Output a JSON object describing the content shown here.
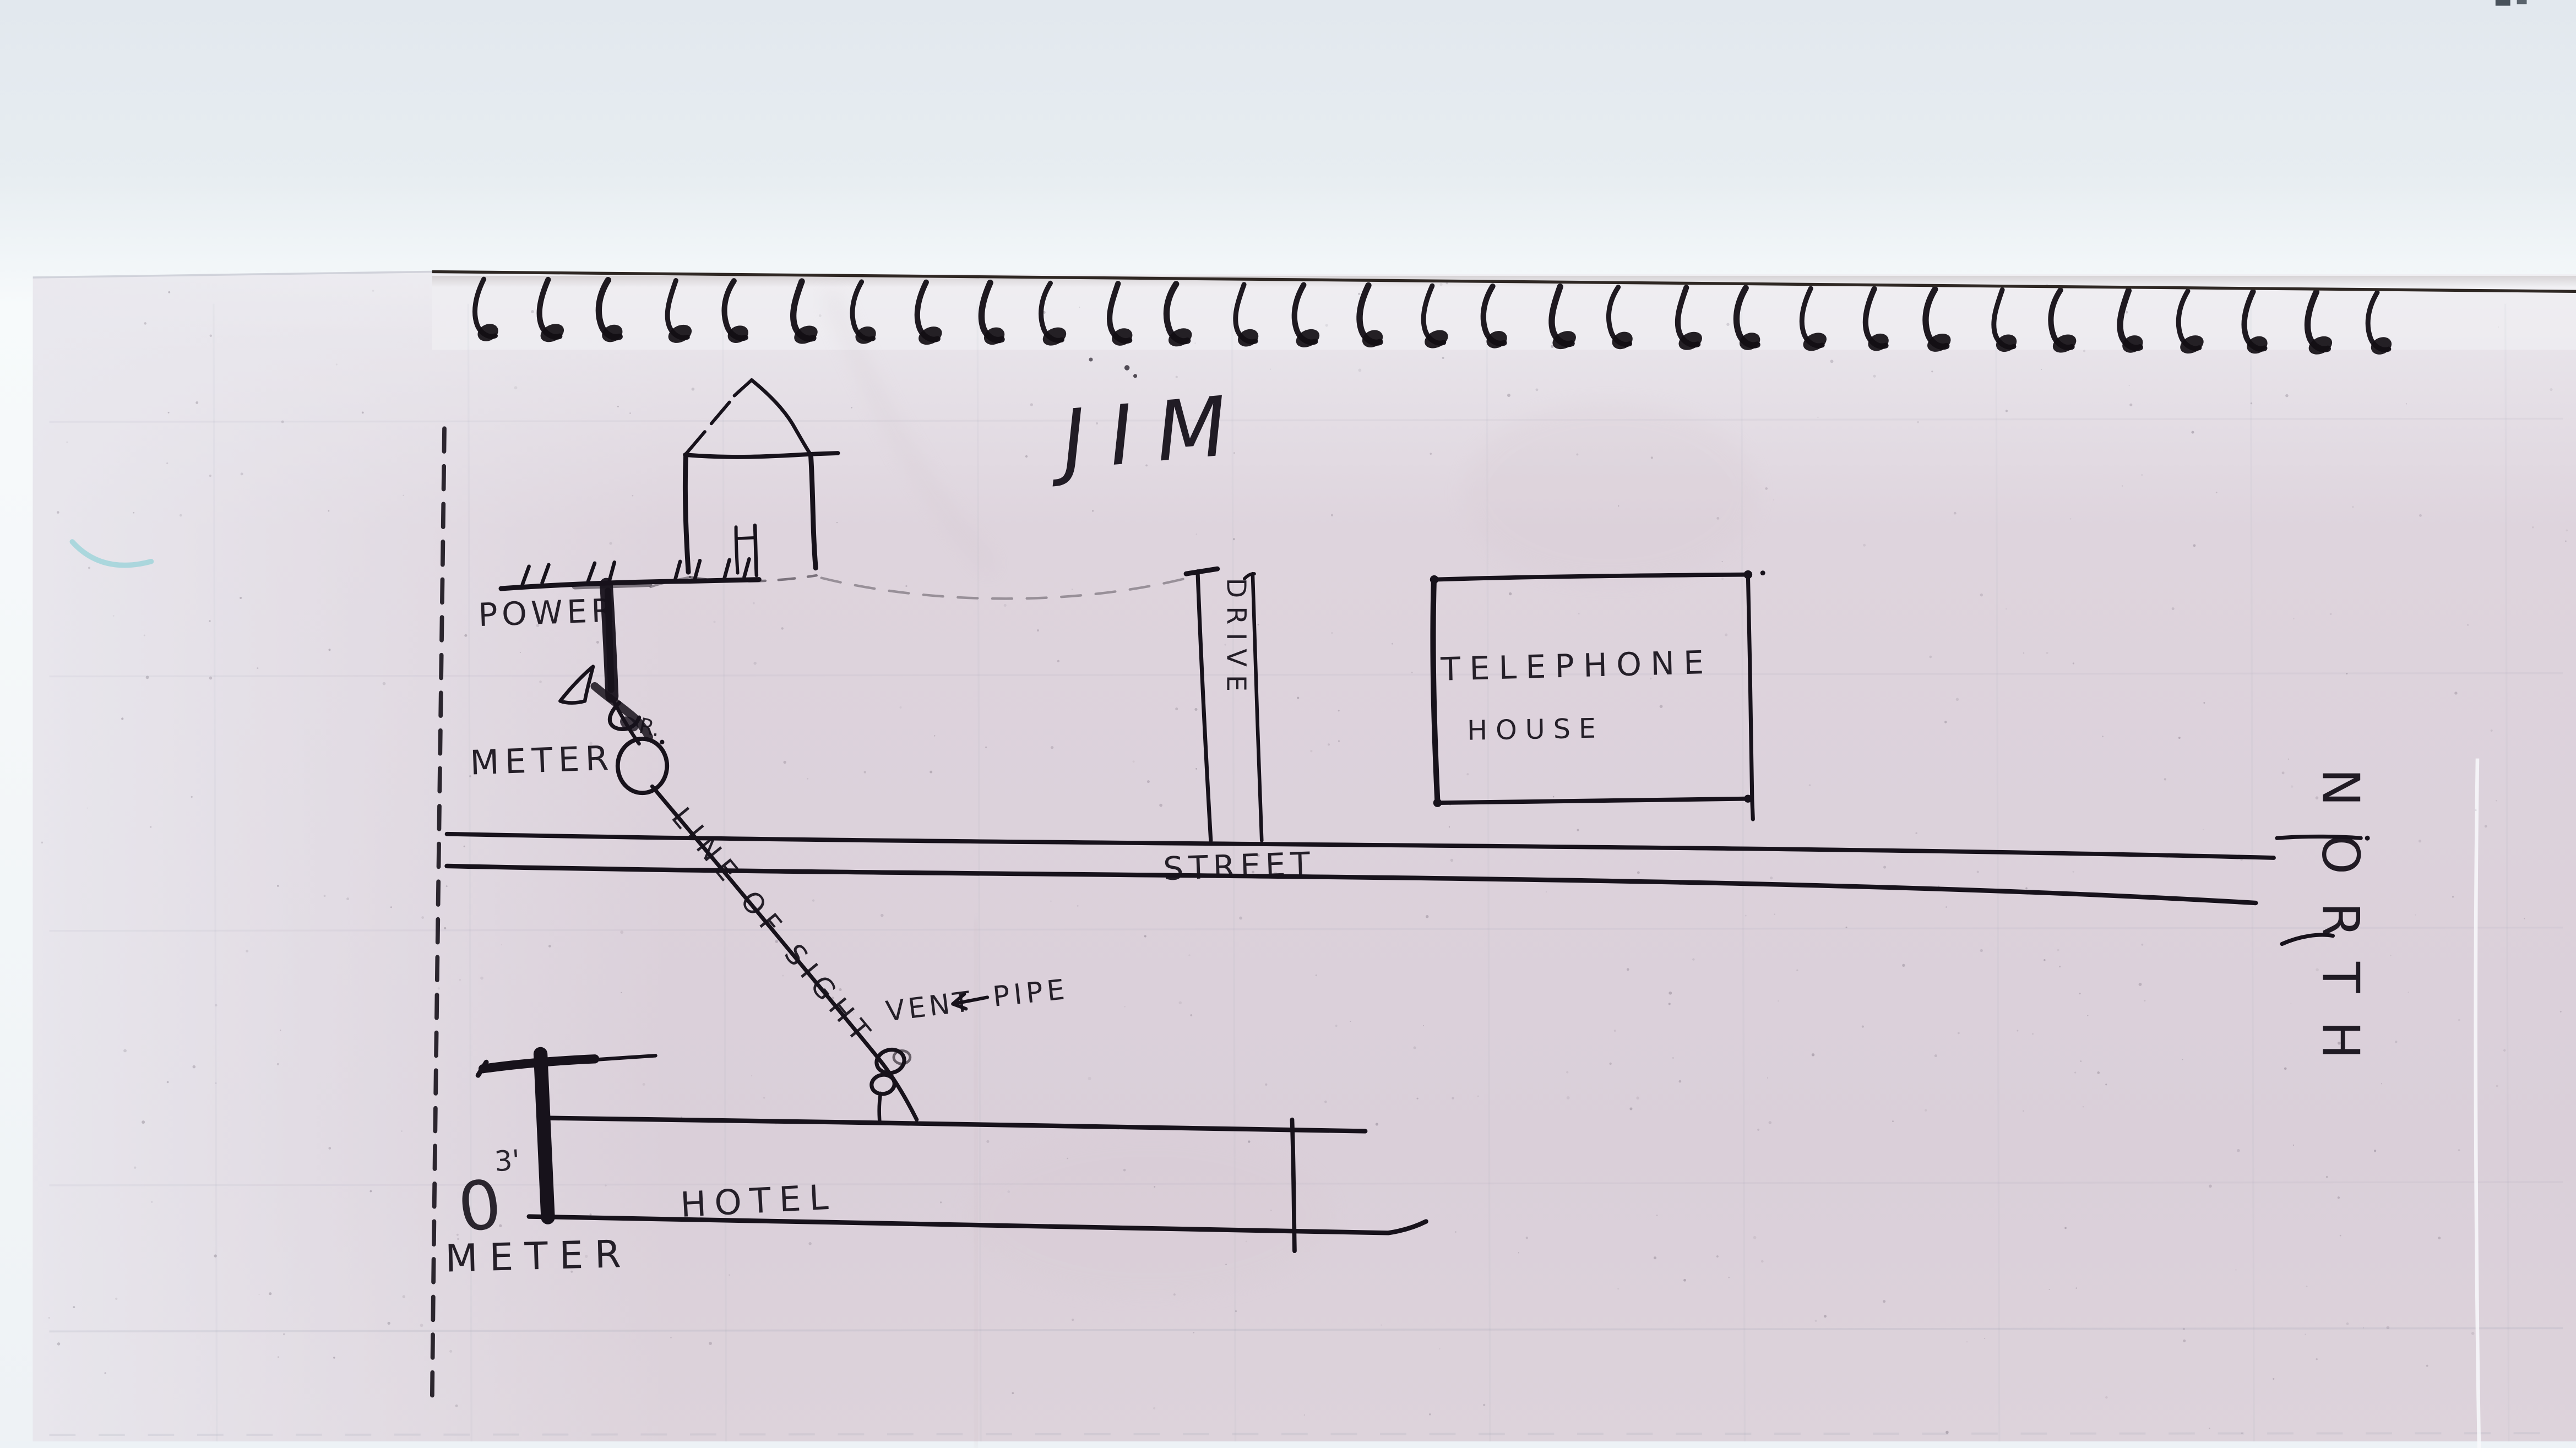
{
  "scan": {
    "description": "Hand-drawn utility site sketch on spiral notebook paper"
  },
  "title": "JIM",
  "labels": {
    "power": "POWER",
    "meter_upper": "METER",
    "drop_r": "R.",
    "line_of_sight": "LINE OF SIGHT",
    "vent": "VENT",
    "pipe": "PIPE",
    "street": "STREET",
    "drive": "DRIVE",
    "telephone_house_line1": "TELEPHONE",
    "telephone_house_line2": "HOUSE",
    "hotel": "HOTEL",
    "north": "NORTH",
    "meter_lower": "METER",
    "height_mark": "3'",
    "meter_symbol": "0"
  },
  "binding": {
    "ring_count": 31
  },
  "colors": {
    "ink": "#17121b",
    "paper": "#ddd4dc",
    "scanner_background": "#e6ebf0",
    "crayon_mark": "#7accd1"
  }
}
